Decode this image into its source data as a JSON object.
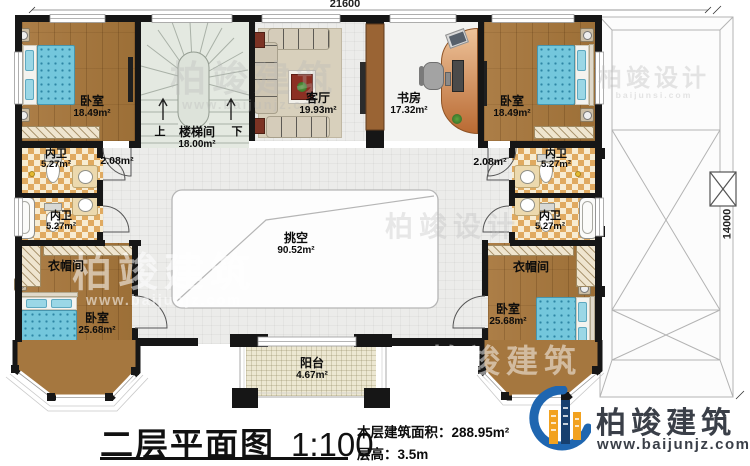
{
  "plan": {
    "drawing_type": "floor-plan",
    "dimensions": {
      "top": "21600",
      "right": "14000"
    },
    "rooms": {
      "bedroom_tl": {
        "name": "卧室",
        "area": "18.49m²"
      },
      "stair": {
        "name": "楼梯间",
        "area": "18.00m²",
        "up": "上",
        "down": "下"
      },
      "living": {
        "name": "客厅",
        "area": "19.93m²"
      },
      "study": {
        "name": "书房",
        "area": "17.32m²"
      },
      "bedroom_tr": {
        "name": "卧室",
        "area": "18.49m²"
      },
      "bath_l1": {
        "name": "内卫",
        "area": "5.27m²"
      },
      "bath_l2": {
        "name": "内卫",
        "area": "5.27m²"
      },
      "bath_r1": {
        "name": "内卫",
        "area": "5.27m²"
      },
      "bath_r2": {
        "name": "内卫",
        "area": "5.27m²"
      },
      "hall_l": {
        "area": "2.08m²"
      },
      "hall_r": {
        "area": "2.08m²"
      },
      "void": {
        "name": "挑空",
        "area": "90.52m²"
      },
      "cloak_l": {
        "name": "衣帽间"
      },
      "cloak_r": {
        "name": "衣帽间"
      },
      "bedroom_bl": {
        "name": "卧室",
        "area": "25.68m²"
      },
      "bedroom_br": {
        "name": "卧室",
        "area": "25.68m²"
      },
      "balcony": {
        "name": "阳台",
        "area": "4.67m²"
      }
    }
  },
  "titleblock": {
    "title": "二层平面图",
    "scale": "1:100",
    "area_label": "本层建筑面积：",
    "area_value": "288.95m²",
    "floor_height_label": "层高：",
    "floor_height_value": "3.5m"
  },
  "brand": {
    "name": "柏竣建筑",
    "url": "www.baijunjz.com"
  },
  "watermarks": {
    "w1": {
      "text": "柏竣建筑",
      "sub": "www.baijunjz.com"
    },
    "w2": {
      "text": "柏竣设计",
      "sub": "baijunsi.com"
    },
    "w3": {
      "text": "柏竣设计",
      "sub": ""
    },
    "w4": {
      "text": "柏竣建筑",
      "sub": "www.baijunjz.com"
    },
    "w5": {
      "text": "柏竣建筑",
      "sub": ""
    }
  },
  "colors": {
    "wall": "#161616",
    "wood_floor": "#a5773f",
    "checker_tile": "#e0aa60",
    "bed_blue": "#74c7dc",
    "stair_floor": "#e4e9e1",
    "balcony_floor": "#ece7d1",
    "logo_blue": "#1f66b0",
    "logo_orange": "#f2a21f",
    "logo_navy": "#17406f",
    "brand_text": "#3a3f48"
  }
}
